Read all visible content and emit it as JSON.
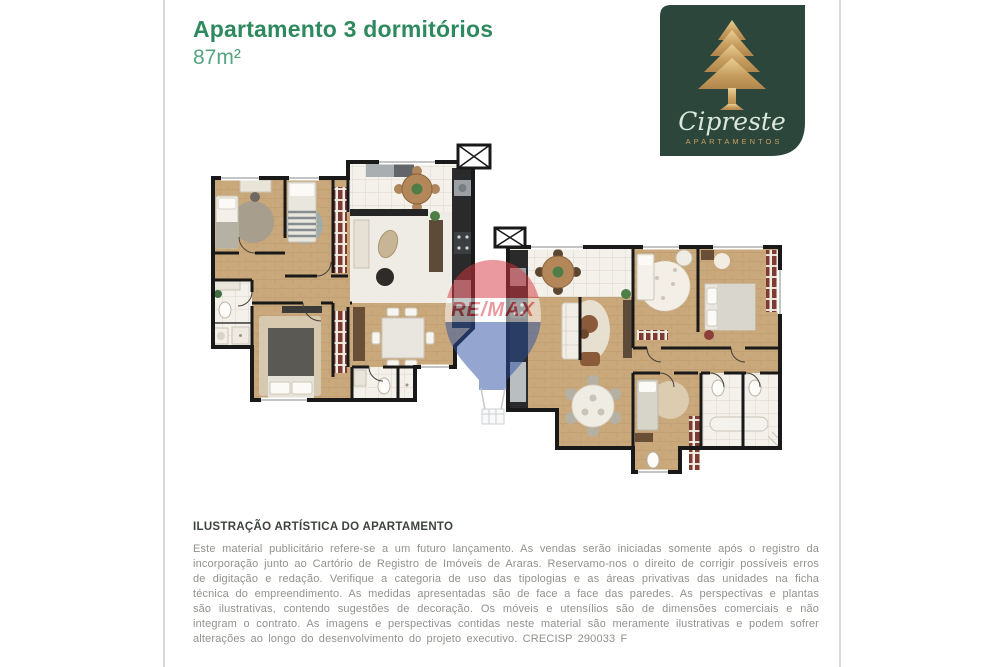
{
  "page": {
    "width": 1000,
    "height": 667,
    "background": "#ffffff"
  },
  "colors": {
    "accent-green": "#2e8a5e",
    "area-green": "#54a47f",
    "logo-bg": "#2c463c",
    "logo-gold": "#c89e5f",
    "logo-script": "#d9e7dc",
    "heading-text": "#3c443d",
    "body-text": "#90938d",
    "frame-line": "#d9d9d9",
    "wall": "#191919",
    "wood-floor": "#c9a87c",
    "tile-floor": "#f4f1ea",
    "wardrobe-red": "#7e3b33",
    "watermark-red": "#d6373f",
    "watermark-blue": "#2b50a1"
  },
  "header": {
    "title": "Apartamento 3 dormitórios",
    "area": "87m²"
  },
  "logo": {
    "brand": "Cipreste",
    "subtitle": "APARTAMENTOS",
    "icon": "cypress-tree-icon"
  },
  "watermark": {
    "text": "RE/MAX",
    "icon": "hot-air-balloon-icon"
  },
  "floor_plans": {
    "shaft_symbol": "X"
  },
  "disclaimer": {
    "heading": "ILUSTRAÇÃO ARTÍSTICA DO APARTAMENTO",
    "body": "Este material publicitário refere-se a um futuro lançamento. As vendas serão iniciadas somente após o registro da incorporação junto ao Cartório de Registro de Imóveis de Araras. Reservamo-nos o direito de corrigir possíveis erros de digitação e redação. Verifique a categoria de uso das tipologias e as áreas privativas das unidades na ficha técnica do empreendimento. As medidas apresentadas são de face a face das paredes. As perspectivas e plantas são ilustrativas, contendo sugestões de decoração. Os móveis e utensílios são de dimensões comerciais e não integram o contrato. As imagens e perspectivas contidas neste material são meramente ilustrativas e podem sofrer alterações ao longo do desenvolvimento do projeto executivo. CRECISP 290033 F"
  }
}
